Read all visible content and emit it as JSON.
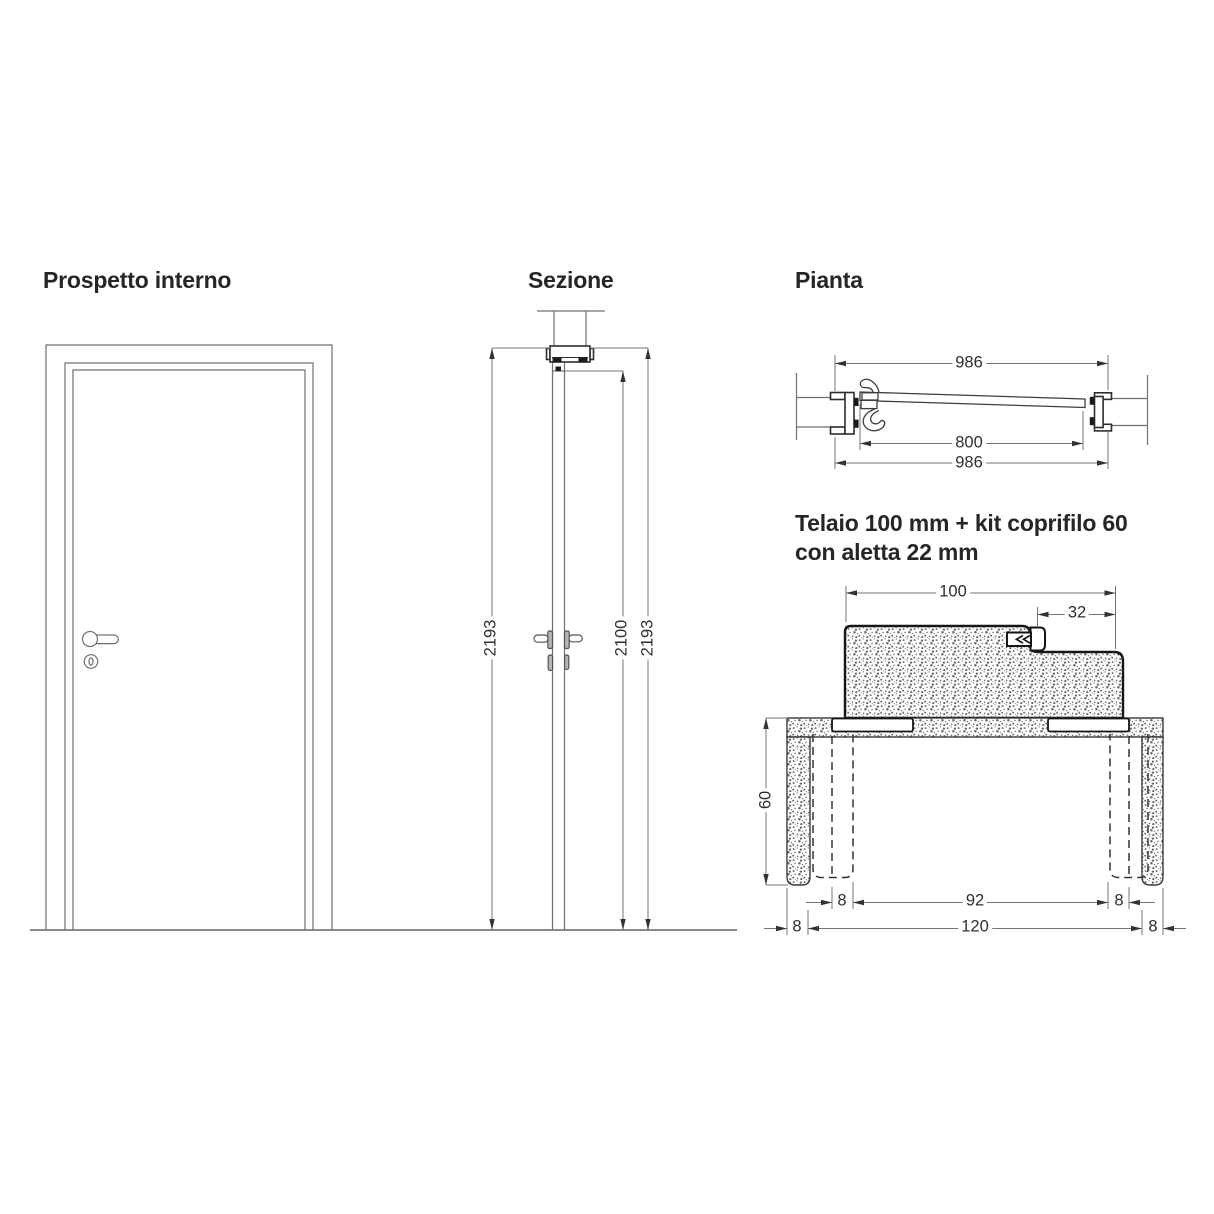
{
  "canvas": {
    "width": 1214,
    "height": 1214,
    "background": "#ffffff"
  },
  "colors": {
    "thin_line": "#6f6f6f",
    "dim_line": "#757575",
    "heavy_line": "#161616",
    "text": "#2f2f2f",
    "hardware_fill": "#b5b5b5"
  },
  "elevation": {
    "title": "Prospetto interno"
  },
  "section": {
    "title": "Sezione",
    "dim_overall_left": "2193",
    "dim_opening": "2100",
    "dim_overall_right": "2193"
  },
  "plan": {
    "title": "Pianta",
    "dim_top": "986",
    "dim_passage": "800",
    "dim_bottom": "986"
  },
  "detail": {
    "title_line1": "Telaio 100 mm + kit coprifilo 60",
    "title_line2": "con aletta 22 mm",
    "dim_frame_depth": "100",
    "dim_coprifilo_step": "32",
    "dim_wall_depth": "60",
    "dim_row1_left": "8",
    "dim_row1_center": "92",
    "dim_row1_right": "8",
    "dim_row2_left": "8",
    "dim_row2_center": "120",
    "dim_row2_right": "8"
  }
}
